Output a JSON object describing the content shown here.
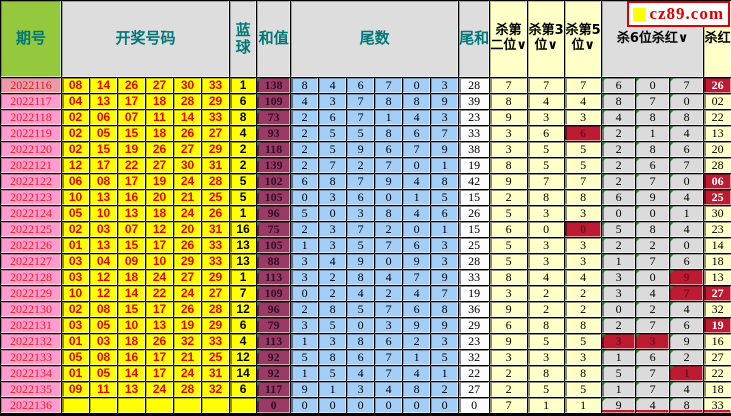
{
  "site": {
    "logo_text": "cz89.com"
  },
  "header": {
    "period": "期号",
    "numbers": "开奖号码",
    "blue": "蓝球",
    "sum": "和值",
    "tails": "尾数",
    "tail_sum": "尾和",
    "kill2": "杀第二位∨",
    "kill3": "杀第3位∨",
    "kill5": "杀第5位∨",
    "kill6": "杀6位杀红∨",
    "kill_red": "杀红"
  },
  "colors": {
    "header_green": "#94c83d",
    "header_gray": "#dddddd",
    "header_teal_text": "#007878",
    "period_pink": "#ff9bce",
    "period_pink_first": "#ec9aa8",
    "ball_yellow": "#ffff00",
    "ball_red_text": "#e60000",
    "sum_maroon": "#9b3a64",
    "tail_blue": "#a3cef8",
    "kill_yellow": "#ffffc8",
    "kill6_gray": "#dbdbdb",
    "hit_red": "#bc1b32",
    "corner_marker_green": "#1e7a2e",
    "logo_red": "#dd0000"
  },
  "rows": [
    {
      "period": "2022116",
      "reds": [
        "08",
        "14",
        "26",
        "27",
        "30",
        "33"
      ],
      "blue": "1",
      "sum": "138",
      "tails": [
        "8",
        "4",
        "6",
        "7",
        "0",
        "3"
      ],
      "tail_sum": "28",
      "kill2": "7",
      "kill3": "7",
      "kill5": "7",
      "kill5_hit": false,
      "kill6": [
        "6",
        "0",
        "7"
      ],
      "kill6_hits": [
        false,
        false,
        false
      ],
      "kill_red": "26",
      "kill_red_hit": true
    },
    {
      "period": "2022117",
      "reds": [
        "04",
        "13",
        "17",
        "18",
        "28",
        "29"
      ],
      "blue": "6",
      "sum": "109",
      "tails": [
        "4",
        "3",
        "7",
        "8",
        "8",
        "9"
      ],
      "tail_sum": "39",
      "kill2": "8",
      "kill3": "4",
      "kill5": "4",
      "kill5_hit": false,
      "kill6": [
        "8",
        "7",
        "0"
      ],
      "kill6_hits": [
        false,
        false,
        false
      ],
      "kill_red": "02",
      "kill_red_hit": false
    },
    {
      "period": "2022118",
      "reds": [
        "02",
        "06",
        "07",
        "11",
        "14",
        "33"
      ],
      "blue": "8",
      "sum": "73",
      "tails": [
        "2",
        "6",
        "7",
        "1",
        "4",
        "3"
      ],
      "tail_sum": "23",
      "kill2": "9",
      "kill3": "3",
      "kill5": "3",
      "kill5_hit": false,
      "kill6": [
        "4",
        "8",
        "8"
      ],
      "kill6_hits": [
        false,
        false,
        false
      ],
      "kill_red": "22",
      "kill_red_hit": false
    },
    {
      "period": "2022119",
      "reds": [
        "02",
        "05",
        "15",
        "18",
        "26",
        "27"
      ],
      "blue": "4",
      "sum": "93",
      "tails": [
        "2",
        "5",
        "5",
        "8",
        "6",
        "7"
      ],
      "tail_sum": "33",
      "kill2": "3",
      "kill3": "6",
      "kill5": "6",
      "kill5_hit": true,
      "kill6": [
        "2",
        "1",
        "4"
      ],
      "kill6_hits": [
        false,
        false,
        false
      ],
      "kill_red": "13",
      "kill_red_hit": false
    },
    {
      "period": "2022120",
      "reds": [
        "02",
        "15",
        "19",
        "26",
        "27",
        "29"
      ],
      "blue": "2",
      "sum": "118",
      "tails": [
        "2",
        "5",
        "9",
        "6",
        "7",
        "9"
      ],
      "tail_sum": "38",
      "kill2": "3",
      "kill3": "5",
      "kill5": "5",
      "kill5_hit": false,
      "kill6": [
        "2",
        "8",
        "6"
      ],
      "kill6_hits": [
        false,
        false,
        false
      ],
      "kill_red": "20",
      "kill_red_hit": false
    },
    {
      "period": "2022121",
      "reds": [
        "12",
        "17",
        "22",
        "27",
        "30",
        "31"
      ],
      "blue": "2",
      "sum": "139",
      "tails": [
        "2",
        "7",
        "2",
        "7",
        "0",
        "1"
      ],
      "tail_sum": "19",
      "kill2": "8",
      "kill3": "5",
      "kill5": "5",
      "kill5_hit": false,
      "kill6": [
        "2",
        "6",
        "7"
      ],
      "kill6_hits": [
        false,
        false,
        false
      ],
      "kill_red": "28",
      "kill_red_hit": false
    },
    {
      "period": "2022122",
      "reds": [
        "06",
        "08",
        "17",
        "19",
        "24",
        "28"
      ],
      "blue": "5",
      "sum": "102",
      "tails": [
        "6",
        "8",
        "7",
        "9",
        "4",
        "8"
      ],
      "tail_sum": "42",
      "kill2": "9",
      "kill3": "7",
      "kill5": "7",
      "kill5_hit": false,
      "kill6": [
        "2",
        "7",
        "0"
      ],
      "kill6_hits": [
        false,
        false,
        false
      ],
      "kill_red": "06",
      "kill_red_hit": true
    },
    {
      "period": "2022123",
      "reds": [
        "10",
        "13",
        "16",
        "20",
        "21",
        "25"
      ],
      "blue": "5",
      "sum": "105",
      "tails": [
        "0",
        "3",
        "6",
        "0",
        "1",
        "5"
      ],
      "tail_sum": "15",
      "kill2": "2",
      "kill3": "8",
      "kill5": "8",
      "kill5_hit": false,
      "kill6": [
        "6",
        "9",
        "4"
      ],
      "kill6_hits": [
        false,
        false,
        false
      ],
      "kill_red": "25",
      "kill_red_hit": true
    },
    {
      "period": "2022124",
      "reds": [
        "05",
        "10",
        "13",
        "18",
        "24",
        "26"
      ],
      "blue": "1",
      "sum": "96",
      "tails": [
        "5",
        "0",
        "3",
        "8",
        "4",
        "6"
      ],
      "tail_sum": "26",
      "kill2": "5",
      "kill3": "3",
      "kill5": "3",
      "kill5_hit": false,
      "kill6": [
        "0",
        "0",
        "1"
      ],
      "kill6_hits": [
        false,
        false,
        false
      ],
      "kill_red": "30",
      "kill_red_hit": false
    },
    {
      "period": "2022125",
      "reds": [
        "02",
        "03",
        "07",
        "12",
        "20",
        "31"
      ],
      "blue": "16",
      "sum": "75",
      "tails": [
        "2",
        "3",
        "7",
        "2",
        "0",
        "1"
      ],
      "tail_sum": "15",
      "kill2": "6",
      "kill3": "0",
      "kill5": "0",
      "kill5_hit": true,
      "kill6": [
        "5",
        "8",
        "4"
      ],
      "kill6_hits": [
        false,
        false,
        false
      ],
      "kill_red": "23",
      "kill_red_hit": false
    },
    {
      "period": "2022126",
      "reds": [
        "01",
        "13",
        "15",
        "17",
        "26",
        "33"
      ],
      "blue": "13",
      "sum": "105",
      "tails": [
        "1",
        "3",
        "5",
        "7",
        "6",
        "3"
      ],
      "tail_sum": "25",
      "kill2": "5",
      "kill3": "3",
      "kill5": "3",
      "kill5_hit": false,
      "kill6": [
        "2",
        "2",
        "0"
      ],
      "kill6_hits": [
        false,
        false,
        false
      ],
      "kill_red": "14",
      "kill_red_hit": false
    },
    {
      "period": "2022127",
      "reds": [
        "03",
        "04",
        "09",
        "10",
        "29",
        "33"
      ],
      "blue": "13",
      "sum": "88",
      "tails": [
        "3",
        "4",
        "9",
        "0",
        "9",
        "3"
      ],
      "tail_sum": "28",
      "kill2": "5",
      "kill3": "3",
      "kill5": "3",
      "kill5_hit": false,
      "kill6": [
        "1",
        "7",
        "6"
      ],
      "kill6_hits": [
        false,
        false,
        false
      ],
      "kill_red": "18",
      "kill_red_hit": false
    },
    {
      "period": "2022128",
      "reds": [
        "03",
        "12",
        "18",
        "24",
        "27",
        "29"
      ],
      "blue": "1",
      "sum": "113",
      "tails": [
        "3",
        "2",
        "8",
        "4",
        "7",
        "9"
      ],
      "tail_sum": "33",
      "kill2": "8",
      "kill3": "4",
      "kill5": "4",
      "kill5_hit": false,
      "kill6": [
        "3",
        "0",
        "9"
      ],
      "kill6_hits": [
        false,
        false,
        true
      ],
      "kill_red": "13",
      "kill_red_hit": false
    },
    {
      "period": "2022129",
      "reds": [
        "10",
        "12",
        "14",
        "22",
        "24",
        "27"
      ],
      "blue": "7",
      "sum": "109",
      "tails": [
        "0",
        "2",
        "4",
        "2",
        "4",
        "7"
      ],
      "tail_sum": "19",
      "kill2": "3",
      "kill3": "2",
      "kill5": "2",
      "kill5_hit": false,
      "kill6": [
        "3",
        "4",
        "7"
      ],
      "kill6_hits": [
        false,
        false,
        true
      ],
      "kill_red": "27",
      "kill_red_hit": true
    },
    {
      "period": "2022130",
      "reds": [
        "02",
        "08",
        "15",
        "17",
        "26",
        "28"
      ],
      "blue": "12",
      "sum": "96",
      "tails": [
        "2",
        "8",
        "5",
        "7",
        "6",
        "8"
      ],
      "tail_sum": "36",
      "kill2": "9",
      "kill3": "2",
      "kill5": "2",
      "kill5_hit": false,
      "kill6": [
        "0",
        "2",
        "4"
      ],
      "kill6_hits": [
        false,
        false,
        false
      ],
      "kill_red": "32",
      "kill_red_hit": false
    },
    {
      "period": "2022131",
      "reds": [
        "03",
        "05",
        "10",
        "13",
        "19",
        "29"
      ],
      "blue": "6",
      "sum": "79",
      "tails": [
        "3",
        "5",
        "0",
        "3",
        "9",
        "9"
      ],
      "tail_sum": "29",
      "kill2": "6",
      "kill3": "8",
      "kill5": "8",
      "kill5_hit": false,
      "kill6": [
        "2",
        "7",
        "6"
      ],
      "kill6_hits": [
        false,
        false,
        false
      ],
      "kill_red": "19",
      "kill_red_hit": true
    },
    {
      "period": "2022132",
      "reds": [
        "01",
        "03",
        "18",
        "26",
        "32",
        "33"
      ],
      "blue": "4",
      "sum": "113",
      "tails": [
        "1",
        "3",
        "8",
        "6",
        "2",
        "3"
      ],
      "tail_sum": "23",
      "kill2": "9",
      "kill3": "5",
      "kill5": "5",
      "kill5_hit": false,
      "kill6": [
        "3",
        "3",
        "9"
      ],
      "kill6_hits": [
        true,
        true,
        false
      ],
      "kill_red": "16",
      "kill_red_hit": false
    },
    {
      "period": "2022133",
      "reds": [
        "05",
        "08",
        "16",
        "17",
        "21",
        "25"
      ],
      "blue": "12",
      "sum": "92",
      "tails": [
        "5",
        "8",
        "6",
        "7",
        "1",
        "5"
      ],
      "tail_sum": "32",
      "kill2": "3",
      "kill3": "3",
      "kill5": "3",
      "kill5_hit": false,
      "kill6": [
        "1",
        "6",
        "2"
      ],
      "kill6_hits": [
        false,
        false,
        false
      ],
      "kill_red": "27",
      "kill_red_hit": false
    },
    {
      "period": "2022134",
      "reds": [
        "01",
        "05",
        "14",
        "17",
        "24",
        "31"
      ],
      "blue": "14",
      "sum": "92",
      "tails": [
        "1",
        "5",
        "4",
        "7",
        "4",
        "1"
      ],
      "tail_sum": "22",
      "kill2": "2",
      "kill3": "8",
      "kill5": "8",
      "kill5_hit": false,
      "kill6": [
        "5",
        "7",
        "1"
      ],
      "kill6_hits": [
        false,
        false,
        true
      ],
      "kill_red": "22",
      "kill_red_hit": false
    },
    {
      "period": "2022135",
      "reds": [
        "09",
        "11",
        "13",
        "24",
        "28",
        "32"
      ],
      "blue": "6",
      "sum": "117",
      "tails": [
        "9",
        "1",
        "3",
        "4",
        "8",
        "2"
      ],
      "tail_sum": "27",
      "kill2": "2",
      "kill3": "5",
      "kill5": "5",
      "kill5_hit": false,
      "kill6": [
        "1",
        "7",
        "4"
      ],
      "kill6_hits": [
        false,
        false,
        false
      ],
      "kill_red": "18",
      "kill_red_hit": false
    },
    {
      "period": "2022136",
      "reds": [
        "",
        "",
        "",
        "",
        "",
        ""
      ],
      "blue": "",
      "sum": "0",
      "tails": [
        "0",
        "0",
        "0",
        "0",
        "0",
        "0"
      ],
      "tail_sum": "0",
      "kill2": "7",
      "kill3": "1",
      "kill5": "1",
      "kill5_hit": false,
      "kill6": [
        "9",
        "4",
        "8"
      ],
      "kill6_hits": [
        false,
        false,
        false
      ],
      "kill_red": "33",
      "kill_red_hit": false
    }
  ]
}
